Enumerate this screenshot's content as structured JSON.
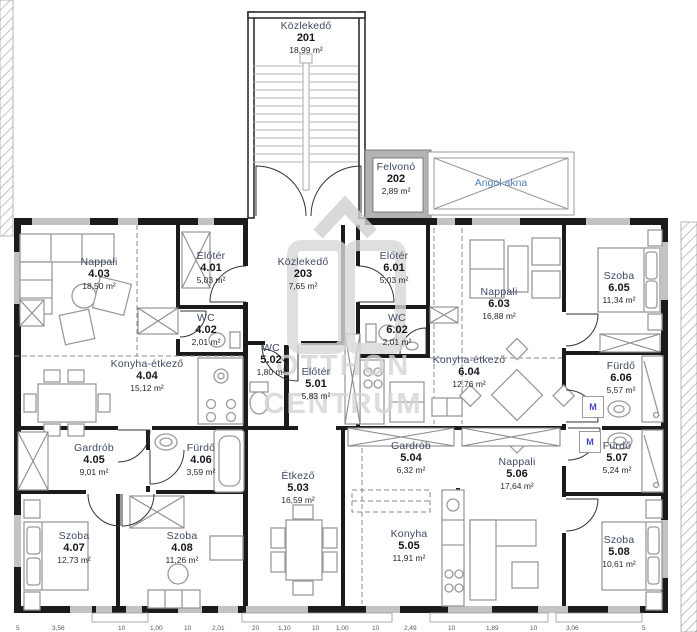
{
  "rooms": [
    {
      "name": "Közlekedő",
      "number": "201",
      "area": "18,99 m²"
    },
    {
      "name": "Felvonó",
      "number": "202",
      "area": "2,89 m²"
    },
    {
      "name": "Közlekedő",
      "number": "203",
      "area": "7,65 m²"
    },
    {
      "name": "Előtér",
      "number": "4.01",
      "area": "5,03 m²"
    },
    {
      "name": "WC",
      "number": "4.02",
      "area": "2,01 m²"
    },
    {
      "name": "Nappali",
      "number": "4.03",
      "area": "18,50 m²"
    },
    {
      "name": "Konyha-étkező",
      "number": "4.04",
      "area": "15,12 m²"
    },
    {
      "name": "Gardrób",
      "number": "4.05",
      "area": "9,01 m²"
    },
    {
      "name": "Fürdő",
      "number": "4.06",
      "area": "3,59 m²"
    },
    {
      "name": "Szoba",
      "number": "4.07",
      "area": "12,73 m²"
    },
    {
      "name": "Szoba",
      "number": "4.08",
      "area": "11,26 m²"
    },
    {
      "name": "Előtér",
      "number": "5.01",
      "area": "5,83 m²"
    },
    {
      "name": "WC",
      "number": "5.02",
      "area": "1,80 m²"
    },
    {
      "name": "Étkező",
      "number": "5.03",
      "area": "16,59 m²"
    },
    {
      "name": "Gardrób",
      "number": "5.04",
      "area": "6,32 m²"
    },
    {
      "name": "Konyha",
      "number": "5.05",
      "area": "11,91 m²"
    },
    {
      "name": "Nappali",
      "number": "5.06",
      "area": "17,64 m²"
    },
    {
      "name": "Fürdő",
      "number": "5.07",
      "area": "5,24 m²"
    },
    {
      "name": "Szoba",
      "number": "5.08",
      "area": "10,61 m²"
    },
    {
      "name": "Előtér",
      "number": "6.01",
      "area": "5,03 m²"
    },
    {
      "name": "WC",
      "number": "6.02",
      "area": "2,01 m²"
    },
    {
      "name": "Nappali",
      "number": "6.03",
      "area": "16,88 m²"
    },
    {
      "name": "Konyha-étkező",
      "number": "6.04",
      "area": "12,76 m²"
    },
    {
      "name": "Szoba",
      "number": "6.05",
      "area": "11,34 m²"
    },
    {
      "name": "Fürdő",
      "number": "6.06",
      "area": "5,57 m²"
    }
  ],
  "light_well_label": "Angol akna",
  "markers": {
    "washing_machine": "M"
  },
  "watermark": {
    "line1": "OTTHON",
    "line2": "CENTRUM"
  },
  "dims": [
    "5",
    "3,56",
    "10",
    "1,00",
    "10",
    "2,01",
    "20",
    "1,10",
    "10",
    "1,00",
    "10",
    "2,49",
    "10",
    "1,89",
    "10",
    "3,06",
    "5"
  ]
}
